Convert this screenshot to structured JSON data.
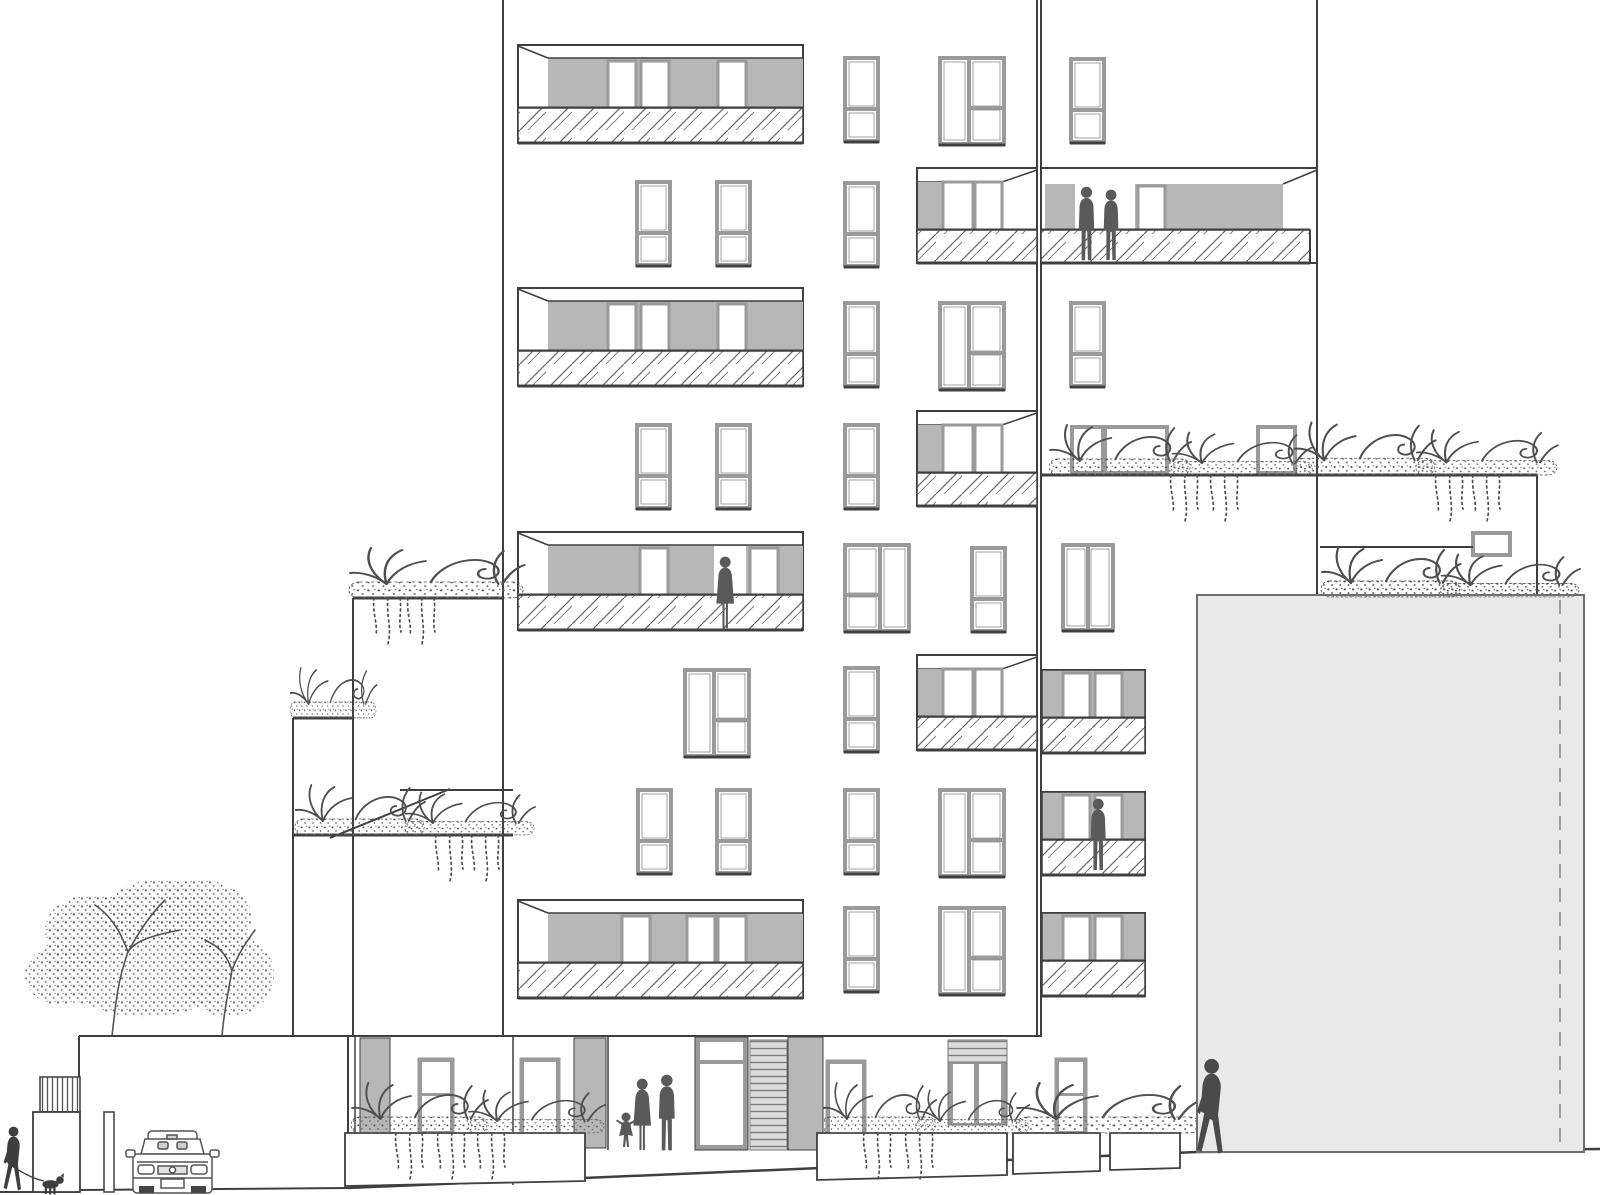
{
  "description": "Architectural street elevation drawing of a stepped residential building with balconies, roof terraces, planting, people, a tree and a parked car",
  "colors": {
    "background": "#ffffff",
    "line": "#3f3f3f",
    "frame": "#9a9a9a",
    "glazing": "#b7b7b7",
    "block": "#e9e9e9",
    "blockline": "#6f6f6f",
    "figure": "#5a5a5a",
    "figuredark": "#3e3e3e",
    "plant": "#4f4f4f",
    "hatch": "#6a6a6a"
  },
  "building": {
    "vertical_edges": [
      [
        503,
        0,
        503,
        1036,
        2
      ],
      [
        1037,
        0,
        1037,
        1036,
        2
      ],
      [
        1041,
        0,
        1041,
        1036,
        2
      ],
      [
        1317,
        0,
        1317,
        597,
        2
      ]
    ],
    "french_windows": [
      [
        637,
        182
      ],
      [
        717,
        182
      ],
      [
        845,
        58
      ],
      [
        845,
        183
      ],
      [
        845,
        303
      ],
      [
        1071,
        59
      ],
      [
        1071,
        303
      ],
      [
        637,
        425
      ],
      [
        717,
        425
      ],
      [
        845,
        425
      ],
      [
        972,
        548
      ],
      [
        845,
        668
      ],
      [
        638,
        790
      ],
      [
        717,
        790
      ],
      [
        845,
        790
      ],
      [
        845,
        908
      ]
    ],
    "wide_windows": [
      [
        940,
        58,
        0
      ],
      [
        940,
        303,
        0
      ],
      [
        685,
        670,
        0
      ],
      [
        940,
        790,
        0
      ],
      [
        940,
        908,
        0
      ],
      [
        845,
        545,
        1
      ]
    ],
    "double_windows": [
      [
        1063,
        545
      ]
    ],
    "left_balconies": [
      {
        "y": 45,
        "panels": [
          608,
          641,
          718
        ]
      },
      {
        "y": 288,
        "panels": [
          608,
          641,
          718
        ]
      },
      {
        "y": 532,
        "panels": [
          640,
          750
        ],
        "opening": 714,
        "figure": 715
      },
      {
        "y": 900,
        "panels": [
          622,
          687,
          718
        ]
      }
    ],
    "right_balconies": [
      {
        "y": 168
      },
      {
        "y": 411
      },
      {
        "y": 655
      }
    ],
    "tower_big_balcony": {
      "y": 168,
      "figures": [
        1076,
        1101
      ]
    },
    "tower_balconies": [
      {
        "y": 670
      },
      {
        "y": 792,
        "figure": 1088
      },
      {
        "y": 913
      }
    ]
  },
  "terraces": {
    "lines": [
      [
        1041,
        475,
        1537,
        475,
        3
      ],
      [
        1537,
        475,
        1537,
        597,
        2
      ],
      [
        1320,
        547,
        1473,
        547,
        2
      ],
      [
        353,
        598,
        503,
        598,
        3
      ],
      [
        353,
        598,
        353,
        1036,
        2
      ],
      [
        293,
        718,
        353,
        718,
        3
      ],
      [
        293,
        718,
        293,
        1036,
        2
      ],
      [
        293,
        835,
        513,
        835,
        3
      ],
      [
        400,
        790,
        513,
        790,
        2
      ],
      [
        450,
        789,
        330,
        838,
        2
      ]
    ],
    "terrace_windows": [
      [
        1072,
        427,
        31,
        46
      ],
      [
        1105,
        427,
        62,
        46
      ],
      [
        1258,
        427,
        37,
        46
      ],
      [
        1473,
        533,
        37,
        22
      ]
    ],
    "plant_rows": [
      {
        "x1": 1046,
        "x2": 1535,
        "base": 475
      },
      {
        "x1": 1318,
        "x2": 1557,
        "base": 597
      },
      {
        "x1": 345,
        "x2": 502,
        "base": 598
      },
      {
        "x1": 288,
        "x2": 353,
        "base": 718
      },
      {
        "x1": 292,
        "x2": 512,
        "base": 835
      }
    ],
    "vines": [
      [
        1165,
        475
      ],
      [
        1205,
        475
      ],
      [
        1430,
        475
      ],
      [
        1467,
        475
      ],
      [
        368,
        598
      ],
      [
        402,
        598
      ],
      [
        430,
        835
      ],
      [
        466,
        835
      ]
    ]
  },
  "ground": {
    "top_line": [
      79,
      1036,
      1042,
      1036,
      2
    ],
    "wall_lines": [
      [
        79,
        1036,
        79,
        1192,
        2
      ],
      [
        348,
        1036,
        348,
        1186,
        2
      ],
      [
        355,
        1036,
        355,
        1150,
        1.5
      ],
      [
        513,
        1036,
        513,
        1185,
        1.5
      ],
      [
        608,
        1036,
        608,
        1150,
        1.5
      ]
    ],
    "ground_lines": [
      [
        0,
        1192,
        79,
        1192,
        2
      ],
      [
        79,
        1190,
        348,
        1188,
        2
      ],
      [
        348,
        1188,
        1197,
        1152,
        2.5
      ],
      [
        1197,
        1152,
        1600,
        1149,
        2.5
      ]
    ],
    "piers": [
      [
        360,
        1038,
        30,
        110
      ],
      [
        574,
        1038,
        32,
        110
      ],
      [
        788,
        1037,
        35,
        113
      ]
    ],
    "framed_windows": [
      [
        418,
        1058,
        36,
        77
      ],
      [
        1055,
        1058,
        32,
        77
      ]
    ],
    "doors": [
      [
        520,
        1058,
        40,
        84
      ],
      [
        826,
        1060,
        40,
        80
      ]
    ],
    "entrance": {
      "x": 695,
      "y": 1037,
      "w": 53,
      "h": 113
    },
    "louver_panel": [
      750,
      1040,
      37,
      110
    ],
    "louver_window": {
      "x": 948,
      "y": 1040,
      "w": 59,
      "stripe_h": 22,
      "pane_h": 63
    },
    "planters": [
      [
        345,
        1133,
        585,
        1133,
        585,
        1181,
        345,
        1186
      ],
      [
        817,
        1133,
        1007,
        1133,
        1007,
        1175,
        817,
        1180
      ],
      [
        1013,
        1133,
        1100,
        1133,
        1100,
        1171,
        1013,
        1174
      ],
      [
        1110,
        1133,
        1180,
        1133,
        1180,
        1168,
        1110,
        1170
      ]
    ],
    "plant_rows": [
      {
        "x1": 348,
        "x2": 582,
        "base": 1133
      },
      {
        "x1": 820,
        "x2": 1006,
        "base": 1133
      },
      {
        "x1": 1012,
        "x2": 1180,
        "base": 1133
      }
    ],
    "vines": [
      [
        390,
        1133
      ],
      [
        432,
        1133
      ],
      [
        472,
        1133
      ],
      [
        858,
        1133
      ],
      [
        900,
        1133
      ]
    ],
    "grate": [
      40,
      1077,
      40,
      35
    ],
    "side_box": [
      33,
      1112,
      47,
      80
    ],
    "post": [
      104,
      1112,
      10,
      80
    ]
  },
  "foreground_block": {
    "x": 1197,
    "y": 595,
    "w": 387,
    "h": 557,
    "dashed_x": 1560
  },
  "figures": {
    "balcony_pair": [
      [
        1076,
        186,
        0.7
      ],
      [
        1101,
        189,
        0.67
      ]
    ],
    "balcony_single_f2": [
      1088,
      798,
      0.7
    ],
    "balcony_skirt_f4": [
      708,
      556,
      0.68
    ],
    "family": {
      "child": [
        616,
        1112,
        1.0
      ],
      "woman": [
        632,
        1078,
        0.68
      ],
      "man": [
        656,
        1074,
        0.72
      ]
    },
    "left_walker": [
      3,
      1126,
      0.62
    ],
    "dog": [
      40,
      1172,
      0.95
    ],
    "right_walker": [
      1196,
      1058,
      0.92
    ]
  },
  "car": {
    "x": 133,
    "y": 1131
  },
  "tree": {
    "trunk_x": 112,
    "base_y": 1036
  }
}
